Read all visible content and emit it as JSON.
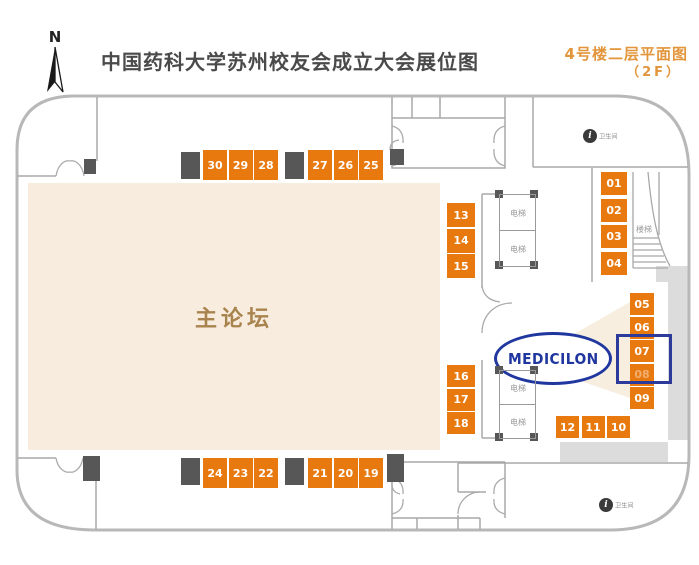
{
  "header": {
    "title": "中国药科大学苏州校友会成立大会展位图",
    "subtitle_line1": "4号楼二层平面图",
    "subtitle_line2": "（2F）",
    "compass_label": "N"
  },
  "map": {
    "main_forum_label": "主论坛",
    "logo_text": "MEDICILON",
    "elevator_label": "电梯",
    "stairs_label": "楼梯",
    "facility_label": "卫生间",
    "highlighted_booth": "07",
    "faded_booth": "08",
    "booth_groups": {
      "top_row_left": [
        "30",
        "29",
        "28"
      ],
      "top_row_right": [
        "27",
        "26",
        "25"
      ],
      "bottom_row_left": [
        "24",
        "23",
        "22"
      ],
      "bottom_row_right": [
        "21",
        "20",
        "19"
      ],
      "mid_left_upper_col": [
        "13",
        "14",
        "15"
      ],
      "mid_left_lower_col": [
        "16",
        "17",
        "18"
      ],
      "right_upper_col": [
        "01",
        "02",
        "03",
        "04"
      ],
      "right_mid_col": [
        "05",
        "06",
        "07",
        "08",
        "09"
      ],
      "right_bottom_row": [
        "12",
        "11",
        "10"
      ]
    },
    "colors": {
      "booth_orange": "#E8790F",
      "pillar_gray": "#575757",
      "wall_gray": "#B5B5B5",
      "forum_beige": "#F7ECDD",
      "corridor_gray": "#DCDCDC",
      "logo_blue": "#20379F",
      "highlight_blue": "#2B3A9B",
      "title_gray": "#4A4A4A",
      "subtitle_orange": "#E2953B",
      "forum_text_brown": "#A9834E"
    }
  }
}
